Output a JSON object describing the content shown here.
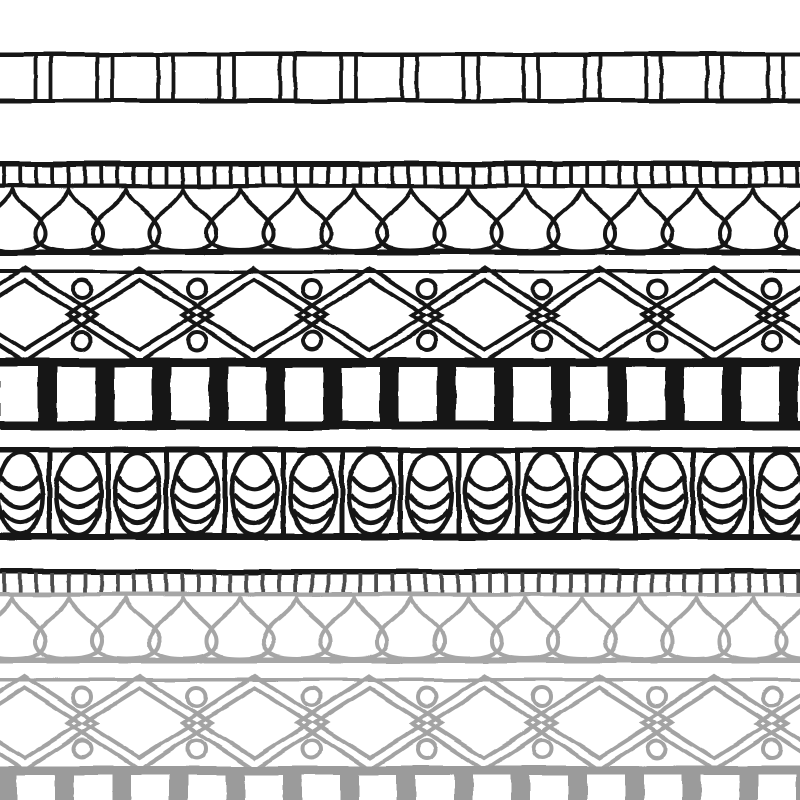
{
  "image": {
    "title": "Ornamental border pattern sheet",
    "width": 800,
    "height": 800,
    "background": "#ffffff"
  },
  "palette": {
    "ink": "#181818",
    "faded_gray": "#a6a6a6",
    "lattice_gray": "#a3a3a3",
    "block_gray": "#9b9b9b",
    "dark_tick_gray": "#4e4e4e",
    "white": "#ffffff"
  },
  "bands": [
    {
      "id": "plank-band",
      "type": "planks",
      "label": "striped plank border",
      "y": 52,
      "height": 51,
      "color": "ink",
      "period": 61,
      "wide_cell": 46,
      "phase": -10,
      "stroke": 3.8
    },
    {
      "id": "lotus-band",
      "type": "ticks_drops",
      "label": "tick row with teardrop lotus border",
      "y": 161,
      "height": 94,
      "line_color": "ink",
      "tick_color": "ink",
      "mid_line_color": "ink",
      "drop_color": "ink",
      "drop_period": 57,
      "drop_phase": 12,
      "tick_period": 16.2
    },
    {
      "id": "lattice-band",
      "type": "lattice",
      "label": "double diamond lattice border with circles",
      "y": 270,
      "height": 88,
      "color": "ink",
      "period": 115,
      "diamond_phase": 24.5
    },
    {
      "id": "block-band",
      "type": "blocks",
      "label": "solid block dentil border",
      "y": 358,
      "height": 72,
      "color": "ink",
      "period": 57,
      "bar_width": 19,
      "phase": 38
    },
    {
      "id": "egg-band",
      "type": "eggs",
      "label": "segmented egg border",
      "y": 447,
      "height": 93,
      "color": "ink",
      "period": 58.5,
      "sep_phase": 49.5
    },
    {
      "id": "lotus-band-faded",
      "type": "ticks_drops",
      "label": "faded tick row with teardrop lotus border",
      "y": 569,
      "height": 94,
      "line_color": "ink",
      "tick_color": "dark_tick_gray",
      "mid_line_color": "faded_gray",
      "drop_color": "faded_gray",
      "drop_period": 57,
      "drop_phase": 12,
      "tick_period": 16.2
    },
    {
      "id": "lattice-band-faded",
      "type": "lattice",
      "label": "faded double diamond lattice border with circles",
      "y": 678,
      "height": 88,
      "color": "lattice_gray",
      "period": 115,
      "diamond_phase": 24.5
    },
    {
      "id": "block-band-faded",
      "type": "blocks",
      "label": "faded solid block dentil border",
      "y": 766,
      "height": 72,
      "color": "block_gray",
      "period": 57,
      "bar_width": 19,
      "phase": -2
    }
  ]
}
